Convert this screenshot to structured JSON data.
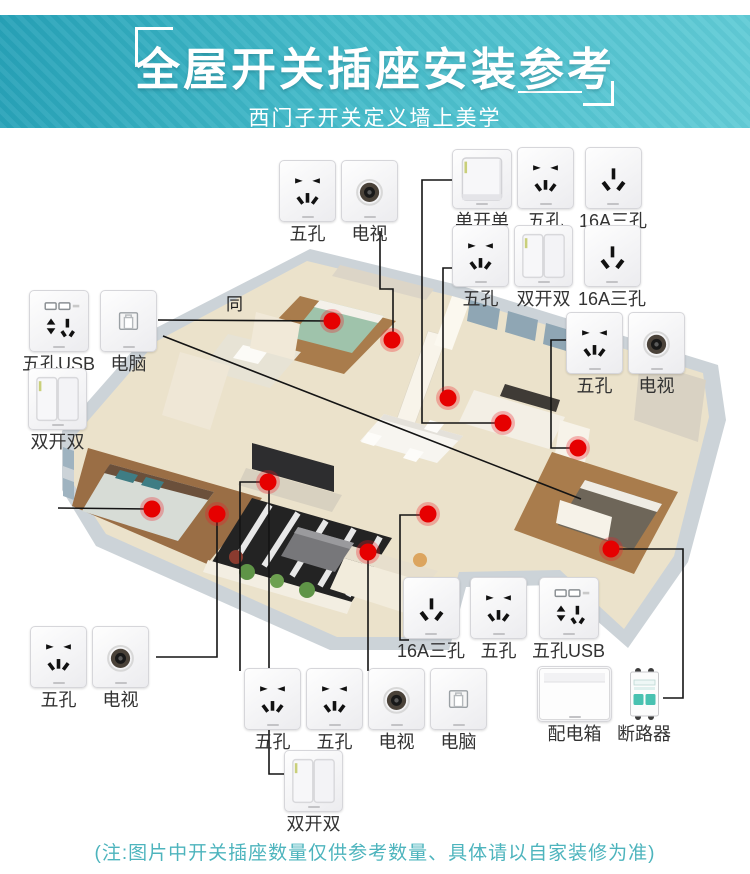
{
  "header": {
    "title": "全屋开关插座安装参考",
    "subtitle": "西门子开关定义墙上美学"
  },
  "note": {
    "text": "(注:图片中开关插座数量仅供参考数量、具体请以自家装修为准)"
  },
  "floor_label": "同",
  "colors": {
    "header_top": "#27a2b8",
    "header_bottom": "#62ccd7",
    "dot": "#e60000",
    "dot_halo": "rgba(237,28,36,0.30)",
    "line": "#141414",
    "note_text": "#4db4bd",
    "label_text": "#333333"
  },
  "groups": [
    {
      "id": "top-left",
      "x": 279,
      "y": 160,
      "items": [
        {
          "type": "five-hole",
          "label": "五孔"
        },
        {
          "type": "tv",
          "label": "电视"
        }
      ]
    },
    {
      "id": "top-right-1",
      "x": 452,
      "y": 147,
      "items": [
        {
          "type": "single-switch",
          "label": "单开单"
        },
        {
          "type": "five-hole",
          "label": "五孔"
        },
        {
          "type": "three-hole",
          "label": "16A三孔"
        }
      ]
    },
    {
      "id": "top-right-2",
      "x": 452,
      "y": 225,
      "items": [
        {
          "type": "five-hole",
          "label": "五孔"
        },
        {
          "type": "double-switch",
          "label": "双开双"
        },
        {
          "type": "three-hole",
          "label": "16A三孔"
        }
      ]
    },
    {
      "id": "right-3",
      "x": 566,
      "y": 312,
      "items": [
        {
          "type": "five-hole",
          "label": "五孔"
        },
        {
          "type": "tv",
          "label": "电视"
        }
      ]
    },
    {
      "id": "left-1",
      "x": 22,
      "y": 290,
      "items": [
        {
          "type": "five-usb",
          "label": "五孔USB"
        },
        {
          "type": "computer",
          "label": "电脑"
        }
      ]
    },
    {
      "id": "left-2",
      "x": 28,
      "y": 368,
      "items": [
        {
          "type": "double-switch",
          "label": "双开双"
        }
      ]
    },
    {
      "id": "bottom-left",
      "x": 30,
      "y": 626,
      "items": [
        {
          "type": "five-hole",
          "label": "五孔"
        },
        {
          "type": "tv",
          "label": "电视"
        }
      ]
    },
    {
      "id": "bottom-mid-1",
      "x": 397,
      "y": 577,
      "items": [
        {
          "type": "three-hole",
          "label": "16A三孔"
        },
        {
          "type": "five-hole",
          "label": "五孔"
        },
        {
          "type": "five-usb",
          "label": "五孔USB"
        }
      ]
    },
    {
      "id": "bottom-mid-2",
      "x": 244,
      "y": 668,
      "items": [
        {
          "type": "five-hole",
          "label": "五孔"
        },
        {
          "type": "five-hole",
          "label": "五孔"
        },
        {
          "type": "tv",
          "label": "电视"
        },
        {
          "type": "computer",
          "label": "电脑"
        }
      ]
    },
    {
      "id": "bottom-right",
      "x": 537,
      "y": 666,
      "items": [
        {
          "type": "dist-box",
          "label": "配电箱"
        },
        {
          "type": "breaker",
          "label": "断路器"
        }
      ]
    },
    {
      "id": "bottom-switch",
      "x": 284,
      "y": 750,
      "items": [
        {
          "type": "double-switch",
          "label": "双开双"
        }
      ]
    }
  ],
  "dots": [
    [
      332,
      321
    ],
    [
      392,
      340
    ],
    [
      448,
      398
    ],
    [
      503,
      423
    ],
    [
      578,
      448
    ],
    [
      268,
      482
    ],
    [
      217,
      514
    ],
    [
      152,
      509
    ],
    [
      428,
      514
    ],
    [
      368,
      552
    ],
    [
      611,
      549
    ]
  ],
  "lines": [
    [
      [
        158,
        320
      ],
      [
        333,
        321
      ]
    ],
    [
      [
        380,
        231
      ],
      [
        380,
        289
      ],
      [
        393,
        289
      ],
      [
        393,
        338
      ]
    ],
    [
      [
        466,
        180
      ],
      [
        422,
        180
      ],
      [
        422,
        423
      ],
      [
        499,
        423
      ]
    ],
    [
      [
        453,
        268
      ],
      [
        443,
        268
      ],
      [
        443,
        395
      ],
      [
        448,
        398
      ]
    ],
    [
      [
        566,
        340
      ],
      [
        551,
        340
      ],
      [
        551,
        448
      ],
      [
        574,
        448
      ]
    ],
    [
      [
        58,
        508
      ],
      [
        150,
        509
      ]
    ],
    [
      [
        156,
        657
      ],
      [
        217,
        657
      ],
      [
        217,
        518
      ]
    ],
    [
      [
        265,
        482
      ],
      [
        240,
        482
      ],
      [
        240,
        671
      ]
    ],
    [
      [
        269,
        486
      ],
      [
        269,
        774
      ],
      [
        286,
        774
      ]
    ],
    [
      [
        368,
        556
      ],
      [
        368,
        671
      ]
    ],
    [
      [
        424,
        515
      ],
      [
        400,
        515
      ],
      [
        400,
        640
      ],
      [
        409,
        640
      ]
    ],
    [
      [
        615,
        549
      ],
      [
        683,
        549
      ],
      [
        683,
        698
      ],
      [
        663,
        698
      ]
    ],
    [
      [
        163,
        336
      ],
      [
        581,
        499
      ]
    ]
  ]
}
